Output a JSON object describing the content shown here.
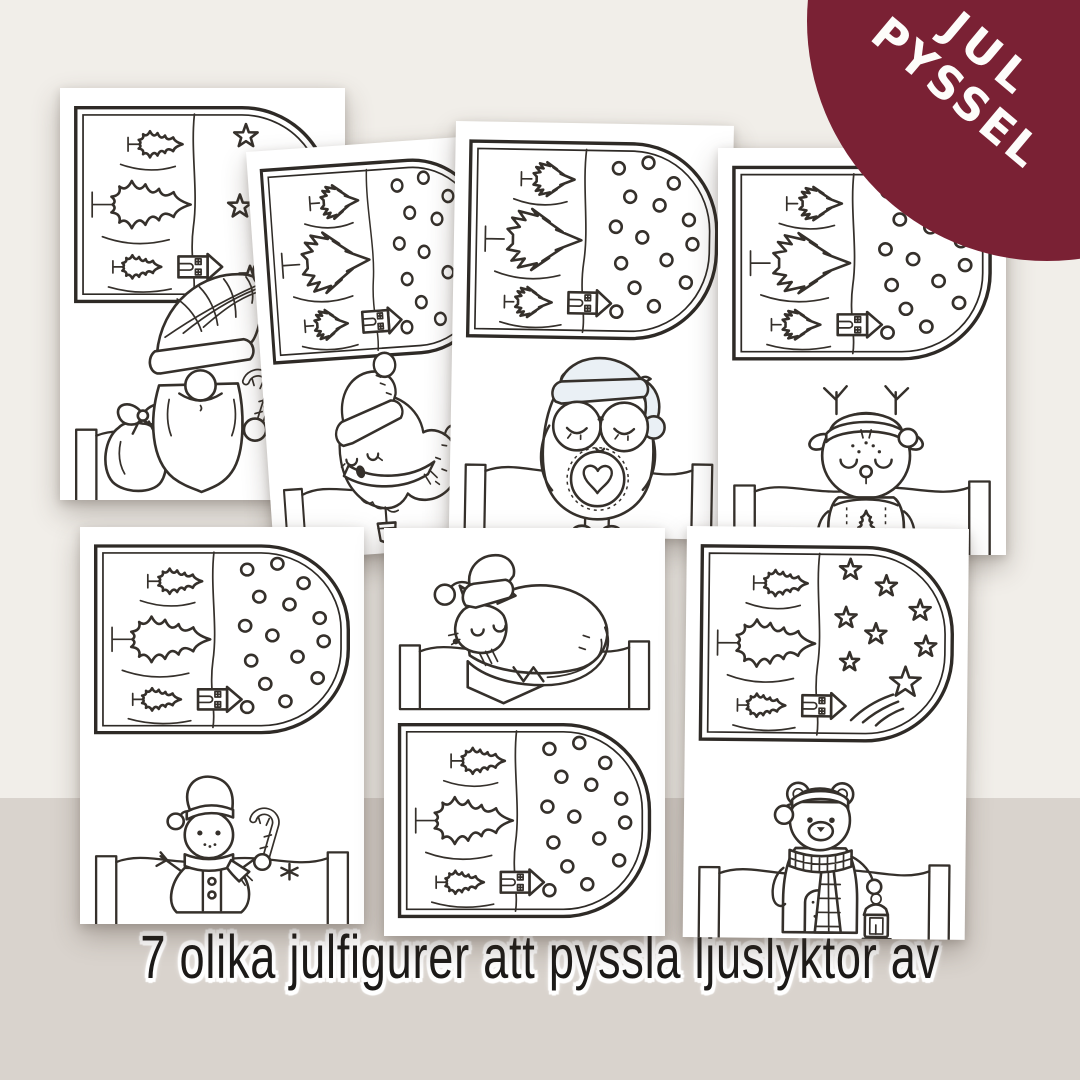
{
  "badge": {
    "line1": "JUL",
    "line2": "PYSSEL",
    "background_color": "#7a2134",
    "text_color": "#fdfcfa"
  },
  "caption": {
    "text": "7 olika julfigurer att pyssla ljuslyktor av",
    "text_color": "#1c1a18",
    "halo_color": "#ffffff"
  },
  "background": {
    "top_color": "#f1eee9",
    "bottom_color": "#d9d3cd"
  },
  "artwork": {
    "ink_color": "#35302b",
    "paper_color": "#ffffff",
    "description": "7 printable snow-globe lantern coloring templates"
  },
  "cards": [
    {
      "character": "gnome-with-sack-and-candy-cane",
      "sky_motif": "stars",
      "tree_style": "wavy",
      "layout": "scene-top"
    },
    {
      "character": "bird-with-santa-hat",
      "sky_motif": "snowfall-dots",
      "tree_style": "jagged",
      "layout": "scene-top"
    },
    {
      "character": "owl-with-glasses",
      "sky_motif": "snowfall-dots",
      "tree_style": "jagged",
      "layout": "scene-top"
    },
    {
      "character": "reindeer-in-sweater",
      "sky_motif": "snowfall-dots",
      "tree_style": "jagged",
      "layout": "scene-top"
    },
    {
      "character": "snowman-with-candy-cane",
      "sky_motif": "snowfall-dots",
      "tree_style": "wavy",
      "layout": "scene-top"
    },
    {
      "character": "sleeping-fox",
      "sky_motif": "snowfall-dots",
      "tree_style": "wavy",
      "layout": "character-top"
    },
    {
      "character": "polar-bear-with-lantern",
      "sky_motif": "stars-and-shooting-star",
      "tree_style": "wavy",
      "layout": "scene-top"
    }
  ]
}
